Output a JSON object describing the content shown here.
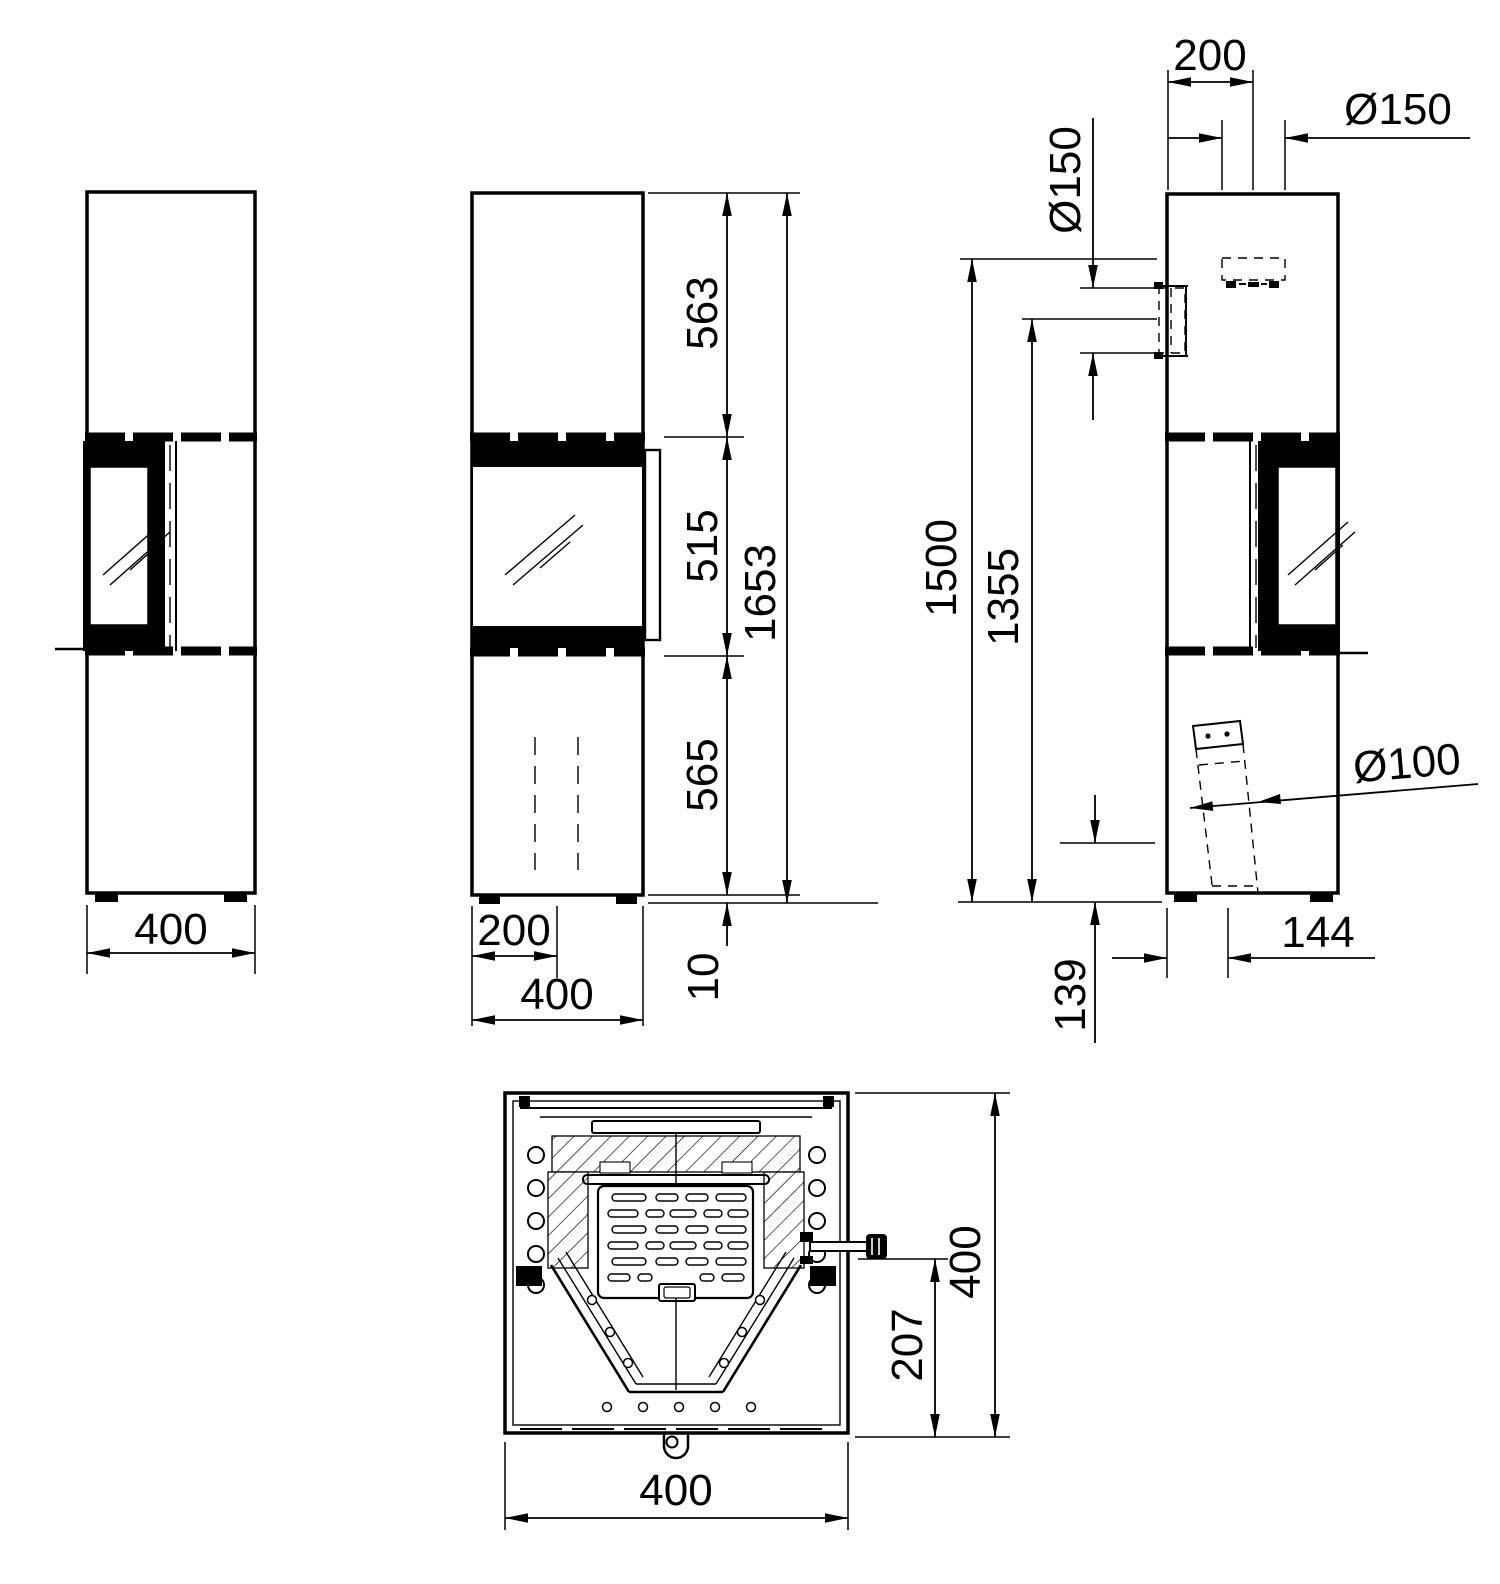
{
  "page": {
    "background": "#ffffff",
    "ink": "#000000",
    "kind": "technical dimensional drawing - stove, four orthographic views"
  },
  "views": {
    "left_side": {
      "width": "400"
    },
    "front": {
      "upper_height": "563",
      "door_height": "515",
      "lower_height": "565",
      "total_height": "1653",
      "plinth_height": "10",
      "center_offset": "200",
      "width": "400"
    },
    "right_side": {
      "flue_center_offset": "200",
      "top_flue_diameter": "Ø150",
      "rear_flue_diameter": "Ø150",
      "rear_flue_top_height": "1500",
      "rear_flue_center_height": "1355",
      "air_duct_diameter": "Ø100",
      "air_duct_center_height": "139",
      "air_duct_center_offset": "144"
    },
    "section": {
      "depth": "400",
      "handle_offset": "207",
      "width": "400"
    }
  }
}
